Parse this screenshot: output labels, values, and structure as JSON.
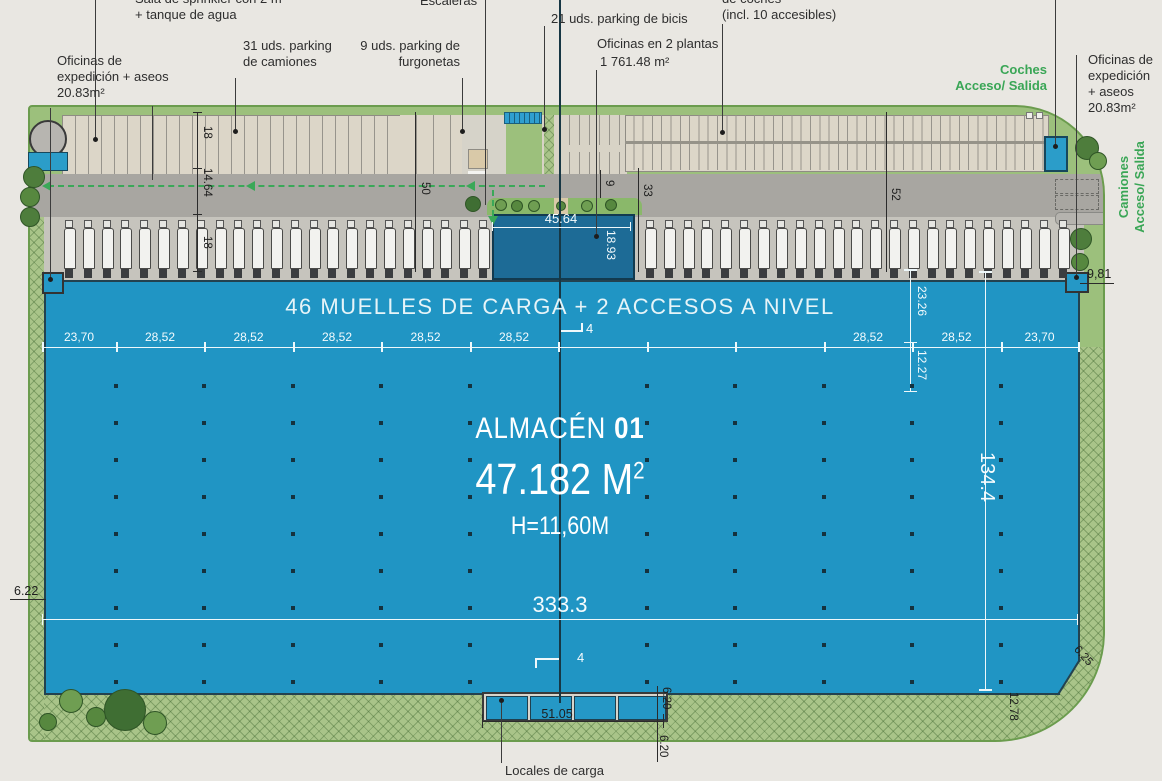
{
  "annotations": {
    "sprinkler": "Sala de sprinkler con 2 m\n+ tanque de agua",
    "offices_left": "Oficinas de\nexpedición + aseos\n20.83m²",
    "trucks_parking": "31 uds. parking\nde camiones",
    "vans_parking": "9 uds. parking de\nfurgonetas",
    "stairs": "Escaleras",
    "bikes_parking": "21 uds. parking de bicis",
    "offices_floors": "Oficinas en 2 plantas",
    "offices_floors_area": "1 761.48 m²",
    "cars_parking": "de coches\n(incl. 10 accesibles)",
    "cars_access": "Coches\nAcceso/ Salida",
    "offices_right": "Oficinas de\nexpedición\n+ aseos\n20.83m²",
    "trucks_access": "Camiones\nAcceso/ Salida",
    "loading_bays": "Locales de carga"
  },
  "warehouse": {
    "banner": "46 MUELLES DE CARGA + 2 ACCESOS A NIVEL",
    "name": "ALMACÉN",
    "unit": "01",
    "area": "47.182 M",
    "area_exp": "2",
    "height": "H=11,60M"
  },
  "dimensions": {
    "top_segments": [
      "23,70",
      "28,52",
      "28,52",
      "28,52",
      "28,52",
      "28,52",
      "",
      "",
      "",
      "28,52",
      "28,52",
      "23,70"
    ],
    "office_width": "45.64",
    "office_depth": "18.93",
    "truck_stall_depth": "18",
    "road_width": "14.64",
    "dock_depth": "18",
    "yard_depth_left": "50",
    "office_gap": "9",
    "yard_33": "33",
    "yard_52": "52",
    "col_23_26": "23.26",
    "col_12_27": "12.27",
    "building_length": "333.3",
    "building_width": "134.4",
    "corner_9_81": "9,81",
    "edge_6_22": "6.22",
    "edge_6_25": "6.25",
    "edge_12_78": "12.78",
    "locals_6_20_a": "6.20",
    "locals_6_20_b": "6.20",
    "locals_width": "51.05",
    "section_marker_top": "4",
    "section_marker_bottom": "4"
  },
  "counts": {
    "docks_left": 23,
    "docks_right": 23
  },
  "colors": {
    "warehouse_blue": "#2095c4",
    "office_blue": "#1d6b96",
    "accent_green": "#3aa656",
    "landscape_green": "#9cc07c",
    "road_gray": "#a8a6a1",
    "parking_beige": "#dcd6c8"
  }
}
